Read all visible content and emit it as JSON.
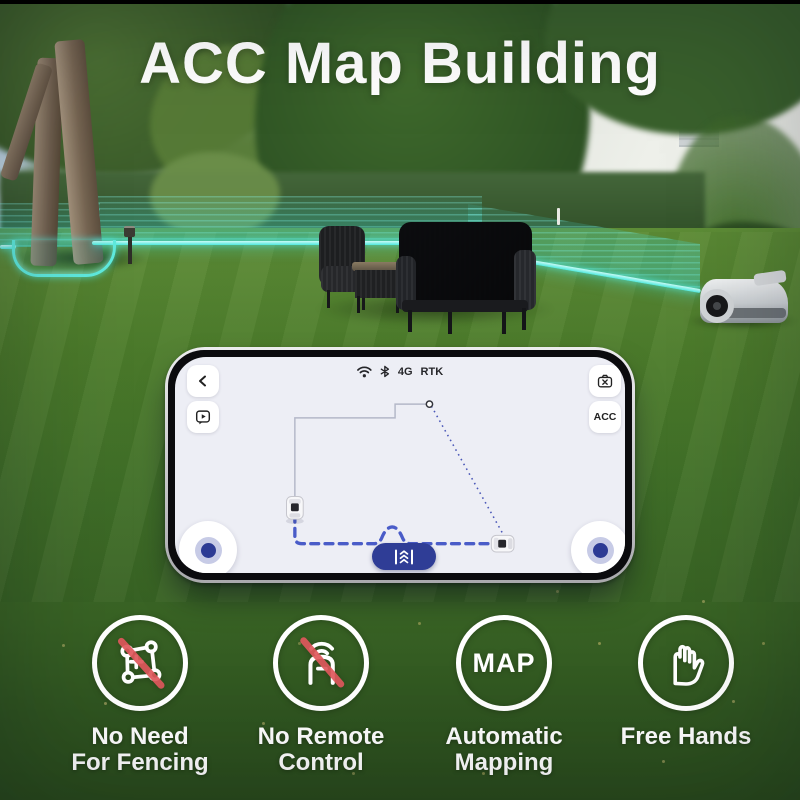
{
  "title": "ACC Map Building",
  "phone": {
    "status": {
      "network": "4G",
      "positioning": "RTK"
    },
    "acc_button": "ACC"
  },
  "features": [
    {
      "lines": [
        "No Need",
        "For Fencing"
      ]
    },
    {
      "lines": [
        "No Remote",
        "Control"
      ]
    },
    {
      "lines": [
        "Automatic",
        "Mapping"
      ],
      "badge": "MAP"
    },
    {
      "lines": [
        "Free Hands"
      ]
    }
  ],
  "icons": {
    "status": [
      "wifi-icon",
      "bluetooth-icon"
    ],
    "phone_buttons": [
      "back-icon",
      "video-tutorial-icon",
      "camera-off-icon",
      "acc-button"
    ],
    "drive_button": "dock-chevrons-icon",
    "feature_icons": [
      "no-fencing-icon",
      "no-remote-icon",
      "map-badge-icon",
      "free-hands-icon"
    ]
  },
  "colors": {
    "accent_navy": "#2f3d96",
    "path_blue": "#4a5cc8",
    "boundary_teal": "#4fe8dd",
    "slash_red": "#e0585d",
    "screen_bg": "#edeef5"
  }
}
